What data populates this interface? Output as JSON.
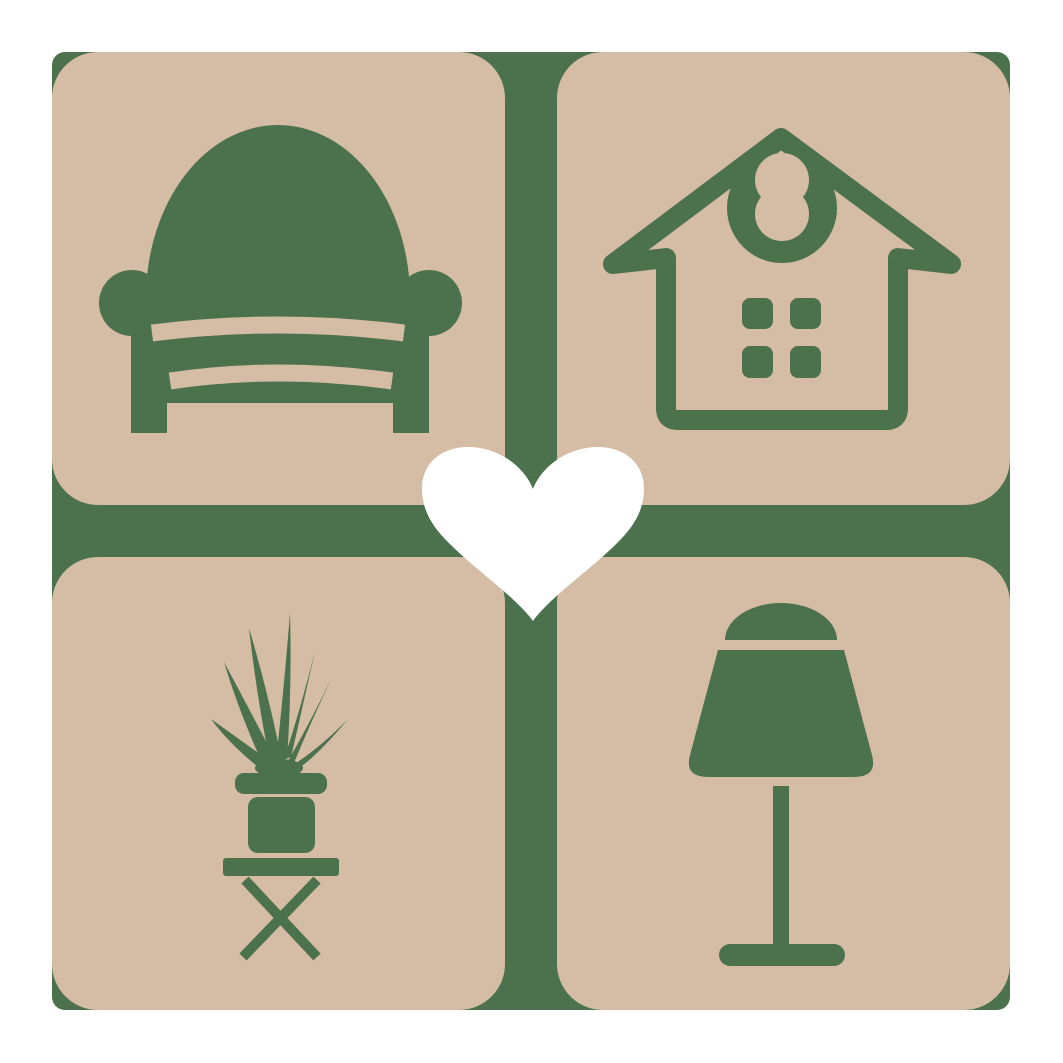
{
  "logo": {
    "name": "home-decor-love-logo",
    "colors": {
      "background": "#ffffff",
      "tile": "#d5bca5",
      "accent": "#4b724d",
      "heart": "#ffffff"
    },
    "tiles": [
      {
        "label": "armchair"
      },
      {
        "label": "house"
      },
      {
        "label": "potted-plant"
      },
      {
        "label": "table-lamp"
      }
    ]
  }
}
